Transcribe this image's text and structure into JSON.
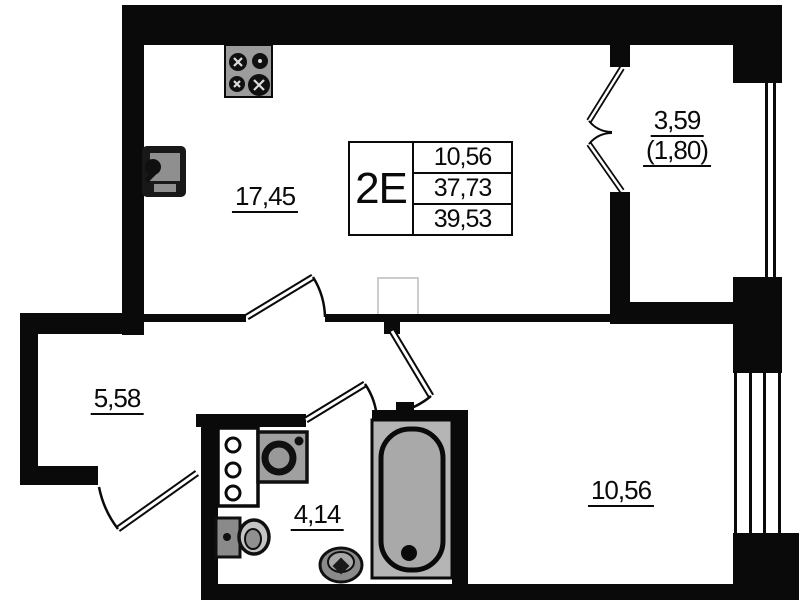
{
  "unit_table": {
    "unit_label": "2E",
    "rows": [
      "10,56",
      "37,73",
      "39,53"
    ]
  },
  "rooms": {
    "living_kitchen_area": "17,45",
    "hallway_area": "5,58",
    "bathroom_area": "4,14",
    "bedroom_area": "10,56"
  },
  "balcony": {
    "area_full": "3,59",
    "area_reduced": "(1,80)"
  },
  "colors": {
    "wall": "#0a0a0a",
    "fixture_gray": "#a9a9a9",
    "paper": "#ffffff"
  }
}
